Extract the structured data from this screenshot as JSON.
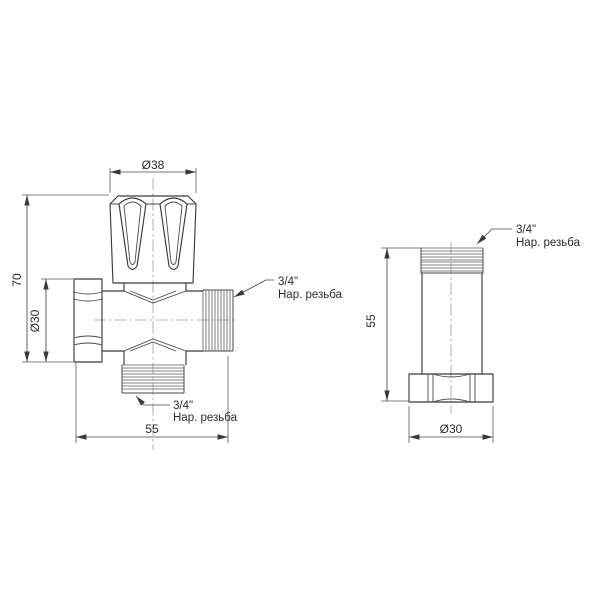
{
  "drawing": {
    "colors": {
      "background": "#ffffff",
      "line": "#3a3a3a",
      "thread": "#5f5f5f",
      "dimension": "#474747",
      "centerline": "#a2a2a2",
      "text": "#2b2b2b"
    },
    "front_view": {
      "dim_handle_diameter": "Ø38",
      "dim_height": "70",
      "dim_nut_diameter": "Ø30",
      "dim_width": "55",
      "side_thread_label": {
        "line1": "3/4\"",
        "line2": "Нар. резьба"
      },
      "bottom_thread_label": {
        "line1": "3/4\"",
        "line2": "Нар. резьба"
      }
    },
    "side_view": {
      "dim_height": "55",
      "dim_nut_diameter": "Ø30",
      "thread_label": {
        "line1": "3/4\"",
        "line2": "Нар. резьба"
      }
    }
  }
}
